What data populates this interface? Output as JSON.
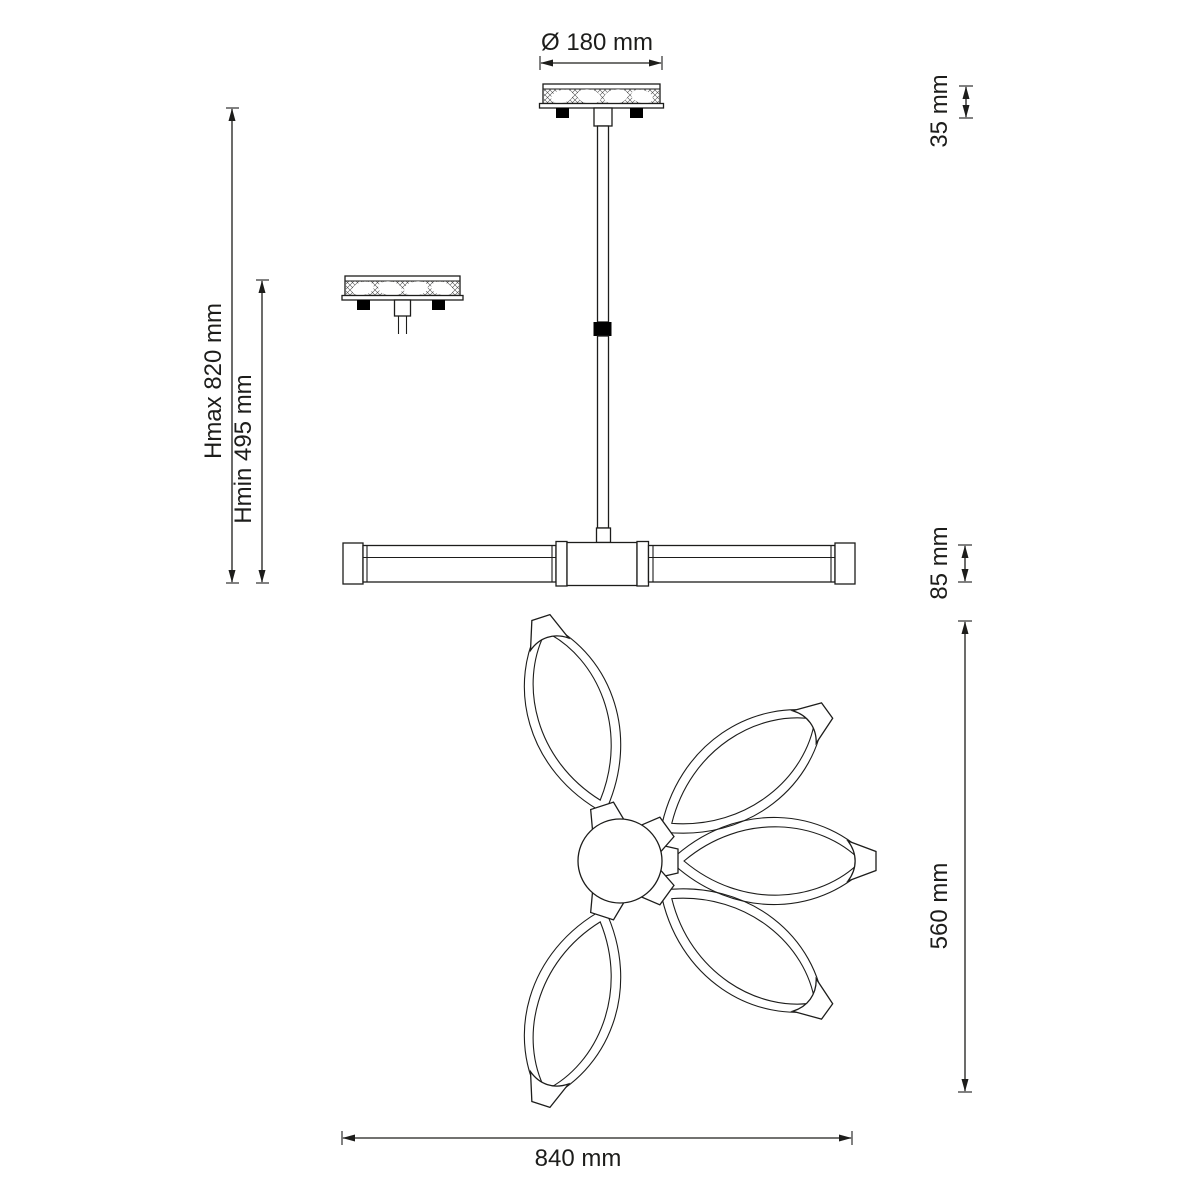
{
  "drawing": {
    "kind": "technical-dimension-drawing",
    "views": [
      "canopy-top-view",
      "canopy-detail-view",
      "pendant-side-view",
      "fixture-bottom-view"
    ],
    "bottom_view": {
      "petal_count": 5
    },
    "colors": {
      "background": "#ffffff",
      "line": "#1d1d1b",
      "solid_black": "#000000"
    }
  },
  "dimensions": {
    "canopy_diameter": {
      "label": "Ø 180 mm",
      "value": 180,
      "unit": "mm"
    },
    "canopy_height": {
      "label": "35 mm",
      "value": 35,
      "unit": "mm"
    },
    "hmax": {
      "label": "Hmax 820 mm",
      "value": 820,
      "unit": "mm"
    },
    "hmin": {
      "label": "Hmin 495 mm",
      "value": 495,
      "unit": "mm"
    },
    "body_height": {
      "label": "85 mm",
      "value": 85,
      "unit": "mm"
    },
    "bottom_depth": {
      "label": "560 mm",
      "value": 560,
      "unit": "mm"
    },
    "bottom_width": {
      "label": "840 mm",
      "value": 840,
      "unit": "mm"
    }
  }
}
